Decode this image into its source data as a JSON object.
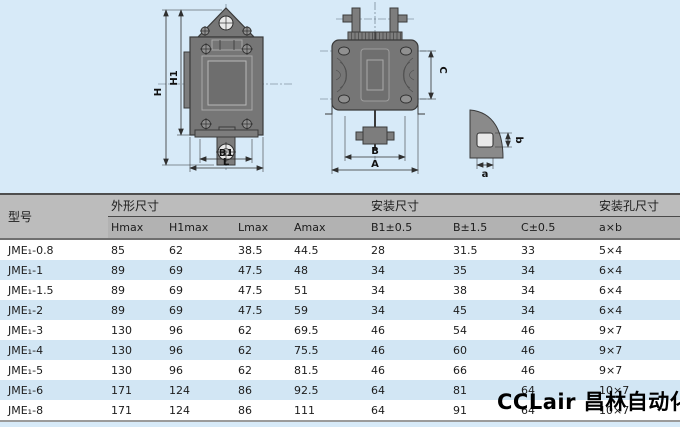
{
  "page": {
    "background": "#d7eaf8"
  },
  "colors": {
    "table_header_bg": "#b7b7b7",
    "row_alt_blue": "#d2e6f4",
    "row_white": "#ffffff",
    "drawing_body_gray": "#767676",
    "watermark_color": "#000000"
  },
  "drawing": {
    "front_view": {
      "dim_h": "H",
      "dim_h1": "H1",
      "dim_b1": "B1",
      "dim_l": "L"
    },
    "side_view": {
      "dim_c": "C",
      "dim_b": "B",
      "dim_a": "A"
    },
    "hole_detail": {
      "dim_b": "b",
      "dim_a": "a"
    }
  },
  "table": {
    "model_header": "型号",
    "groups": [
      {
        "label": "外形尺寸",
        "span": 4
      },
      {
        "label": "安装尺寸",
        "span": 3
      },
      {
        "label": "安装孔尺寸",
        "span": 1
      }
    ],
    "subheaders": [
      "Hmax",
      "H1max",
      "Lmax",
      "Amax",
      "B1±0.5",
      "B±1.5",
      "C±0.5",
      "a×b"
    ],
    "rows": [
      {
        "model": "JME₁-0.8",
        "values": [
          "85",
          "62",
          "38.5",
          "44.5",
          "28",
          "31.5",
          "33",
          "5×4"
        ]
      },
      {
        "model": "JME₁-1",
        "values": [
          "89",
          "69",
          "47.5",
          "48",
          "34",
          "35",
          "34",
          "6×4"
        ]
      },
      {
        "model": "JME₁-1.5",
        "values": [
          "89",
          "69",
          "47.5",
          "51",
          "34",
          "38",
          "34",
          "6×4"
        ]
      },
      {
        "model": "JME₁-2",
        "values": [
          "89",
          "69",
          "47.5",
          "59",
          "34",
          "45",
          "34",
          "6×4"
        ]
      },
      {
        "model": "JME₁-3",
        "values": [
          "130",
          "96",
          "62",
          "69.5",
          "46",
          "54",
          "46",
          "9×7"
        ]
      },
      {
        "model": "JME₁-4",
        "values": [
          "130",
          "96",
          "62",
          "75.5",
          "46",
          "60",
          "46",
          "9×7"
        ]
      },
      {
        "model": "JME₁-5",
        "values": [
          "130",
          "96",
          "62",
          "81.5",
          "46",
          "66",
          "46",
          "9×7"
        ]
      },
      {
        "model": "JME₁-6",
        "values": [
          "171",
          "124",
          "86",
          "92.5",
          "64",
          "81",
          "64",
          "10×7"
        ]
      },
      {
        "model": "JME₁-8",
        "values": [
          "171",
          "124",
          "86",
          "111",
          "64",
          "91",
          "64",
          "10×7"
        ]
      }
    ]
  },
  "watermark": {
    "text": "CCLair 昌林自动化"
  }
}
